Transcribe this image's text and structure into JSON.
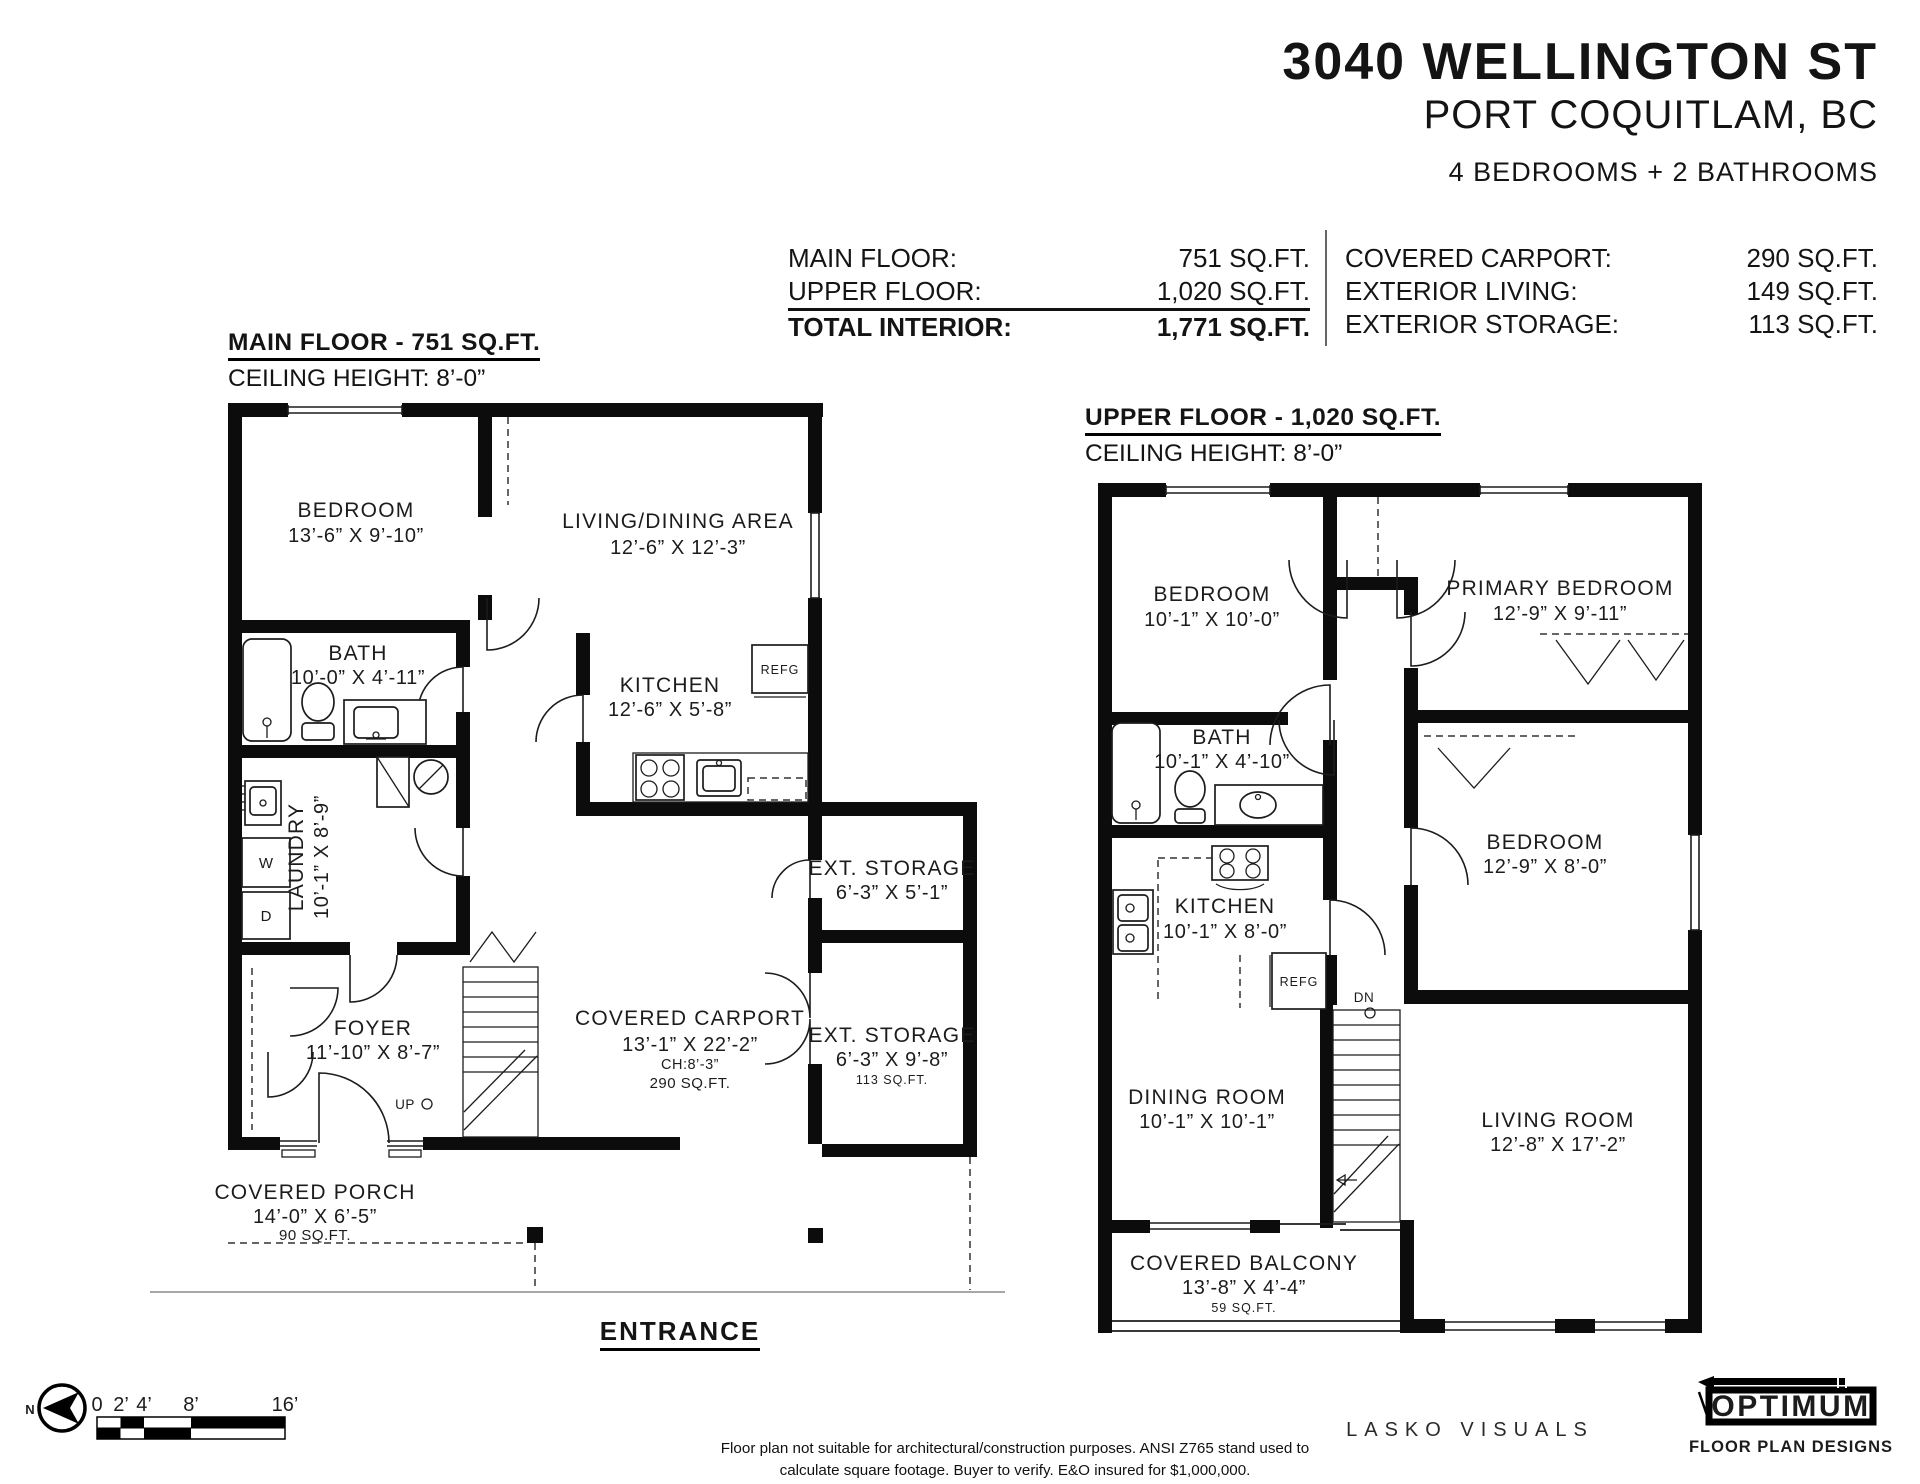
{
  "header": {
    "address": "3040 WELLINGTON ST",
    "city": "PORT COQUITLAM, BC",
    "beds_baths": "4 BEDROOMS + 2 BATHROOMS"
  },
  "area_table": {
    "left": [
      {
        "label": "MAIN FLOOR:",
        "value": "751 SQ.FT."
      },
      {
        "label": "UPPER FLOOR:",
        "value": "1,020 SQ.FT."
      },
      {
        "label": "TOTAL INTERIOR:",
        "value": "1,771 SQ.FT."
      }
    ],
    "right": [
      {
        "label": "COVERED CARPORT:",
        "value": "290 SQ.FT."
      },
      {
        "label": "EXTERIOR LIVING:",
        "value": "149 SQ.FT."
      },
      {
        "label": "EXTERIOR STORAGE:",
        "value": "113 SQ.FT."
      }
    ]
  },
  "main_floor": {
    "title": "MAIN FLOOR - 751 SQ.FT.",
    "ceiling": "CEILING HEIGHT: 8’-0”",
    "rooms": {
      "bedroom": {
        "name": "BEDROOM",
        "dims": "13’-6” X 9’-10”"
      },
      "living": {
        "name": "LIVING/DINING AREA",
        "dims": "12’-6” X 12’-3”"
      },
      "bath": {
        "name": "BATH",
        "dims": "10’-0” X 4’-11”"
      },
      "kitchen": {
        "name": "KITCHEN",
        "dims": "12’-6” X 5’-8”"
      },
      "laundry": {
        "name": "LAUNDRY",
        "dims": "10’-1” X 8’-9”"
      },
      "foyer": {
        "name": "FOYER",
        "dims": "11’-10” X 8’-7”"
      },
      "carport": {
        "name": "COVERED CARPORT",
        "dims": "13’-1” X 22’-2”",
        "ch": "CH:8’-3”",
        "area": "290 SQ.FT."
      },
      "storage1": {
        "name": "EXT. STORAGE",
        "dims": "6’-3” X 5’-1”"
      },
      "storage2": {
        "name": "EXT. STORAGE",
        "dims": "6’-3” X 9’-8”",
        "area": "113 SQ.FT."
      },
      "porch": {
        "name": "COVERED PORCH",
        "dims": "14’-0” X 6’-5”",
        "area": "90 SQ.FT."
      }
    },
    "labels": {
      "refg": "REFG",
      "washer": "W",
      "dryer": "D",
      "up": "UP"
    },
    "entrance": "ENTRANCE"
  },
  "upper_floor": {
    "title": "UPPER FLOOR - 1,020 SQ.FT.",
    "ceiling": "CEILING HEIGHT: 8’-0”",
    "rooms": {
      "bedroom2": {
        "name": "BEDROOM",
        "dims": "10’-1” X 10’-0”"
      },
      "primary": {
        "name": "PRIMARY BEDROOM",
        "dims": "12’-9” X 9’-11”"
      },
      "bath": {
        "name": "BATH",
        "dims": "10’-1” X 4’-10”"
      },
      "bedroom3": {
        "name": "BEDROOM",
        "dims": "12’-9” X 8’-0”"
      },
      "kitchen": {
        "name": "KITCHEN",
        "dims": "10’-1” X 8’-0”"
      },
      "dining": {
        "name": "DINING ROOM",
        "dims": "10’-1” X 10’-1”"
      },
      "living": {
        "name": "LIVING ROOM",
        "dims": "12’-8” X 17’-2”"
      },
      "balcony": {
        "name": "COVERED BALCONY",
        "dims": "13’-8” X 4’-4”",
        "area": "59 SQ.FT."
      }
    },
    "labels": {
      "refg": "REFG",
      "dn": "DN"
    }
  },
  "footer": {
    "north": "N",
    "scale_ticks": [
      "0",
      "2’",
      "4’",
      "8’",
      "16’"
    ],
    "disclaimer_line1": "Floor plan not suitable for architectural/construction purposes. ANSI Z765 stand used to",
    "disclaimer_line2": "calculate square footage. Buyer to verify.  E&O insured for $1,000,000.",
    "credit": "LASKO VISUALS",
    "logo_name": "OPTIMUM",
    "logo_sub": "FLOOR PLAN DESIGNS"
  }
}
